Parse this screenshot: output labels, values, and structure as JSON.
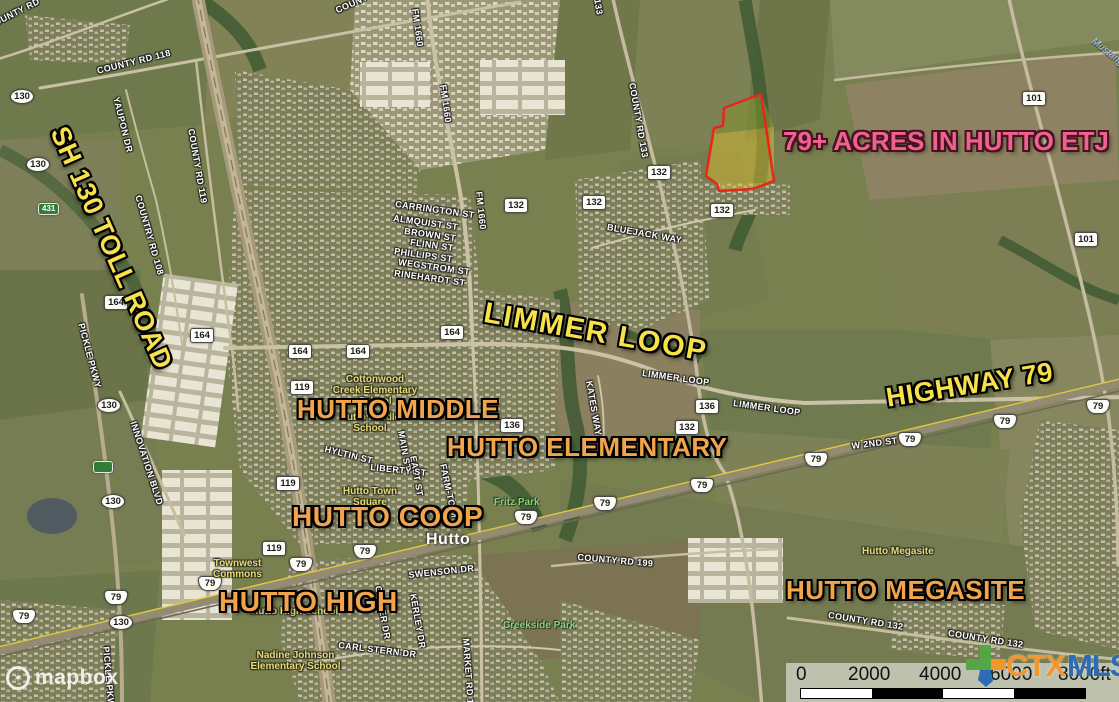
{
  "headline": {
    "text": "79+ ACRES IN HUTTO ETJ"
  },
  "annotations": {
    "sh130": "SH 130 TOLL ROAD",
    "limmer_loop": "LIMMER LOOP",
    "highway79": "HIGHWAY 79",
    "hutto_middle": "HUTTO MIDDLE",
    "hutto_elementary": "HUTTO ELEMENTARY",
    "hutto_coop": "HUTTO COOP",
    "hutto_high": "HUTTO HIGH",
    "hutto_megasite": "HUTTO MEGASITE"
  },
  "roads": [
    {
      "t": "COUNTY RD 118"
    },
    {
      "t": "YAUPON DR"
    },
    {
      "t": "COUNTY RD 119"
    },
    {
      "t": "COUNTRY RD 108"
    },
    {
      "t": "COUNTY RD"
    },
    {
      "t": "COUNTY RD"
    },
    {
      "t": "FM 1660"
    },
    {
      "t": "FM 1660"
    },
    {
      "t": "FM 1660"
    },
    {
      "t": "COUNTY RD 133"
    },
    {
      "t": "133"
    },
    {
      "t": "CARRINGTON ST"
    },
    {
      "t": "ALMQUIST ST"
    },
    {
      "t": "BROWN ST"
    },
    {
      "t": "FLINN ST"
    },
    {
      "t": "PHILLIPS ST"
    },
    {
      "t": "WEGSTROM ST"
    },
    {
      "t": "RINEHARDT ST"
    },
    {
      "t": "BLUEJACK WAY"
    },
    {
      "t": "LIMMER LOOP"
    },
    {
      "t": "LIMMER LOOP"
    },
    {
      "t": "W 2ND ST"
    },
    {
      "t": "KATES WAY"
    },
    {
      "t": "FARM-TO-M"
    },
    {
      "t": "EAST ST"
    },
    {
      "t": "MAIN ST"
    },
    {
      "t": "HYLTIN ST"
    },
    {
      "t": "LIBERTY ST"
    },
    {
      "t": "SWENSON DR"
    },
    {
      "t": "GAINER DR"
    },
    {
      "t": "KERLEY DR"
    },
    {
      "t": "CARL STERN DR"
    },
    {
      "t": "MARKET RD 1660"
    },
    {
      "t": "COUNTY RD 199"
    },
    {
      "t": "COUNTY RD 132"
    },
    {
      "t": "COUNTY RD 132"
    },
    {
      "t": "INNOVATION BLVD"
    },
    {
      "t": "PICKLE PKWY"
    },
    {
      "t": "PICKLE PKWY"
    }
  ],
  "shields": [
    {
      "n": "130"
    },
    {
      "n": "130"
    },
    {
      "n": "130"
    },
    {
      "n": "130"
    },
    {
      "n": "130"
    },
    {
      "n": "101"
    },
    {
      "n": "101"
    },
    {
      "n": "164"
    },
    {
      "n": "164"
    },
    {
      "n": "164"
    },
    {
      "n": "164"
    },
    {
      "n": "164"
    },
    {
      "n": "119"
    },
    {
      "n": "119"
    },
    {
      "n": "119"
    },
    {
      "n": "136"
    },
    {
      "n": "136"
    },
    {
      "n": "132"
    },
    {
      "n": "132"
    },
    {
      "n": "132"
    },
    {
      "n": "132"
    },
    {
      "n": "132"
    },
    {
      "n": "79"
    },
    {
      "n": "79"
    },
    {
      "n": "79"
    },
    {
      "n": "79"
    },
    {
      "n": "79"
    },
    {
      "n": "79"
    },
    {
      "n": "79"
    },
    {
      "n": "79"
    },
    {
      "n": "79"
    },
    {
      "n": "79"
    },
    {
      "n": "79"
    },
    {
      "n": "79"
    },
    {
      "n": "431"
    },
    {
      "n": ""
    }
  ],
  "places": [
    {
      "t": "Cottonwood\nCreek Elementary\nSchool"
    },
    {
      "t": "Hutto Middle\nSchool"
    },
    {
      "t": "Hutto Town\nSquare"
    },
    {
      "t": "Townwest\nCommons"
    },
    {
      "t": "Hutto High School"
    },
    {
      "t": "Nadine Johnson\nElementary School"
    },
    {
      "t": "Hutto Megasite"
    }
  ],
  "parks": [
    {
      "t": "Fritz Park"
    },
    {
      "t": "Creekside Park"
    }
  ],
  "city": {
    "name": "Hutto"
  },
  "water": {
    "name": "Mustang Cr"
  },
  "scalebar": {
    "ticks": [
      "0",
      "2000",
      "4000",
      "6000",
      "8000ft"
    ]
  },
  "logos": {
    "mapbox": "mapbox",
    "ctx": "CTX",
    "mls": "MLS"
  },
  "colors": {
    "headline_pink": "#ef6190",
    "label_yellow": "#f8e24c",
    "label_orange": "#f1a44c",
    "parcel_outline": "#e8271b",
    "parcel_fill": "#d8c634",
    "ctx_orange": "#f0982e",
    "mls_blue": "#2c6cb4"
  }
}
